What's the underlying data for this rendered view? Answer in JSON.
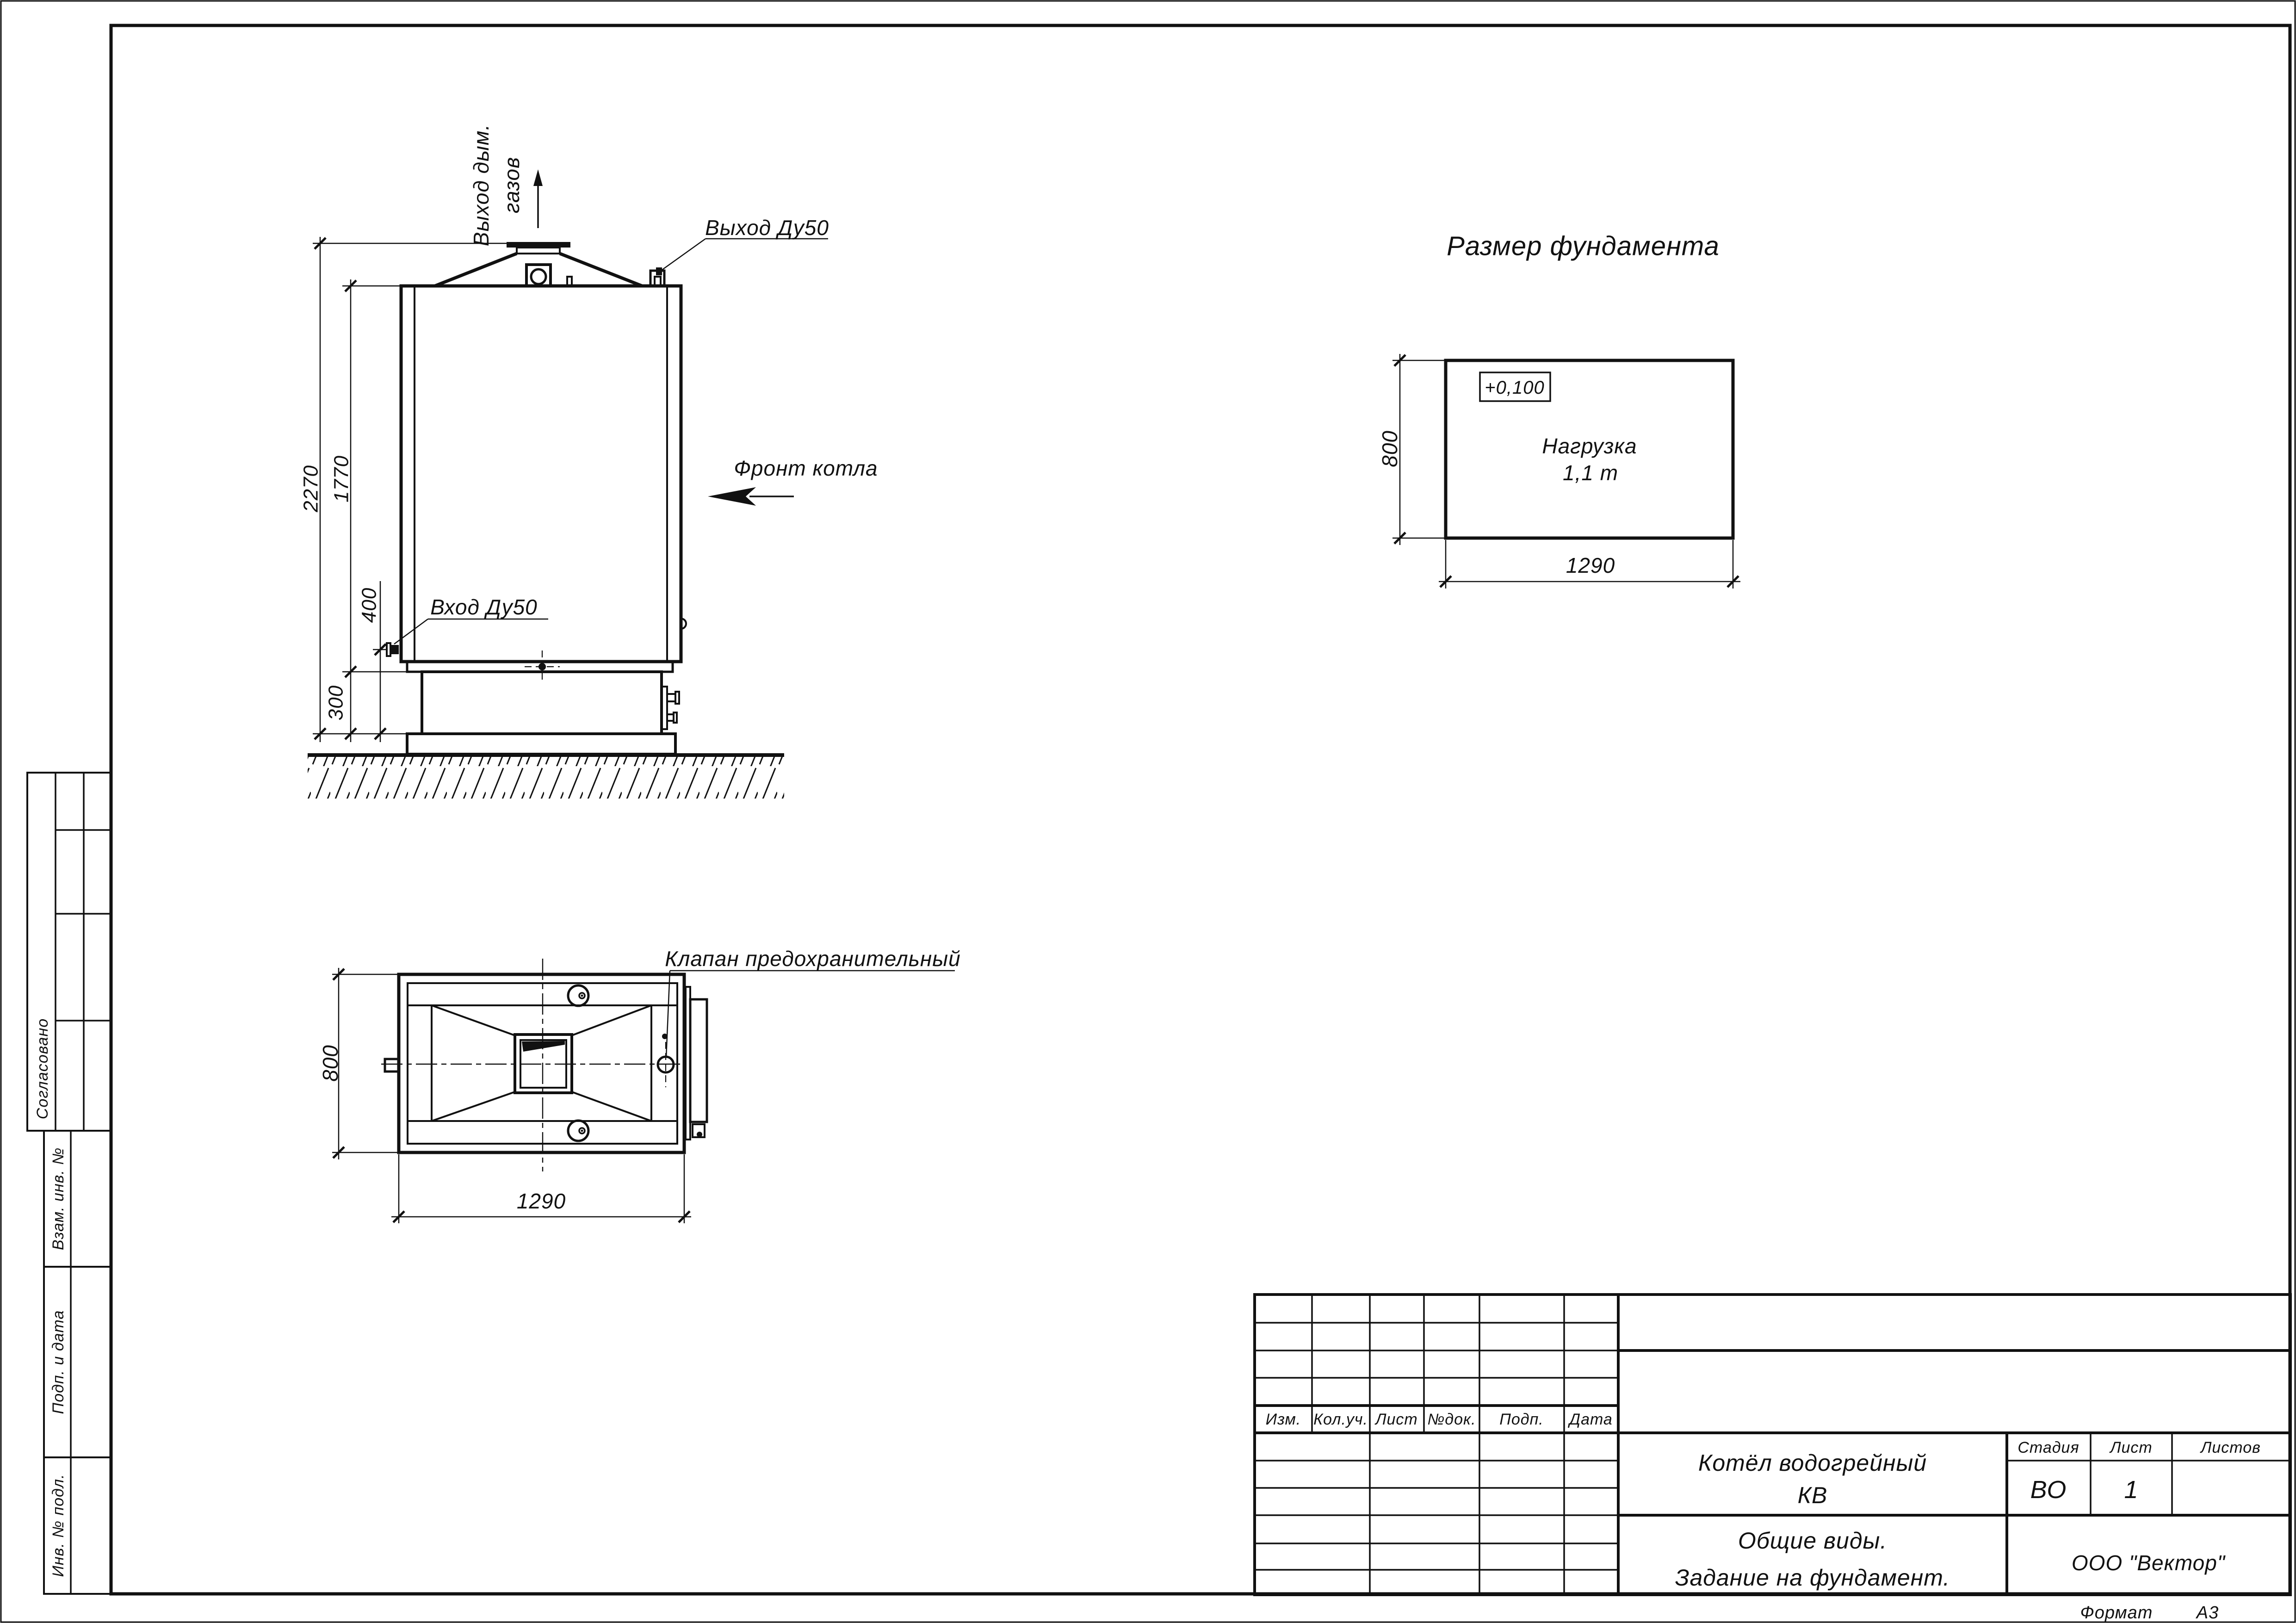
{
  "sheet": {
    "format_label": "Формат",
    "format_value": "А3"
  },
  "front_view": {
    "labels": {
      "flue_exit_line1": "Выход дым.",
      "flue_exit_line2": "газов",
      "outlet": "Выход Ду50",
      "inlet": "Вход Ду50",
      "front": "Фронт котла"
    },
    "dims": {
      "h_total": "2270",
      "h_body": "1770",
      "h_inlet": "400",
      "h_base": "300"
    }
  },
  "plan_view": {
    "labels": {
      "safety_valve": "Клапан предохранительный"
    },
    "dims": {
      "width": "1290",
      "depth": "800"
    }
  },
  "foundation_plan": {
    "title": "Размер фундамента",
    "elevation_mark": "+0,100",
    "load_line1": "Нагрузка",
    "load_line2": "1,1 т",
    "dims": {
      "width": "1290",
      "depth": "800"
    }
  },
  "title_block": {
    "columns": [
      "Изм.",
      "Кол.уч.",
      "Лист",
      "№док.",
      "Подп.",
      "Дата"
    ],
    "doc_name_line1": "Котёл водогрейный",
    "doc_name_line2": "КВ",
    "doc_type_line1": "Общие виды.",
    "doc_type_line2": "Задание на фундамент.",
    "stage_label": "Стадия",
    "sheet_label": "Лист",
    "sheets_label": "Листов",
    "stage_value": "ВО",
    "sheet_value": "1",
    "sheets_value": "",
    "company": "ООО \"Вектор\""
  },
  "side_stamp": {
    "agreed": "Согласовано",
    "replace_inv": "Взам. инв. №",
    "sign_date": "Подп. и дата",
    "inv_orig": "Инв. № подл."
  }
}
